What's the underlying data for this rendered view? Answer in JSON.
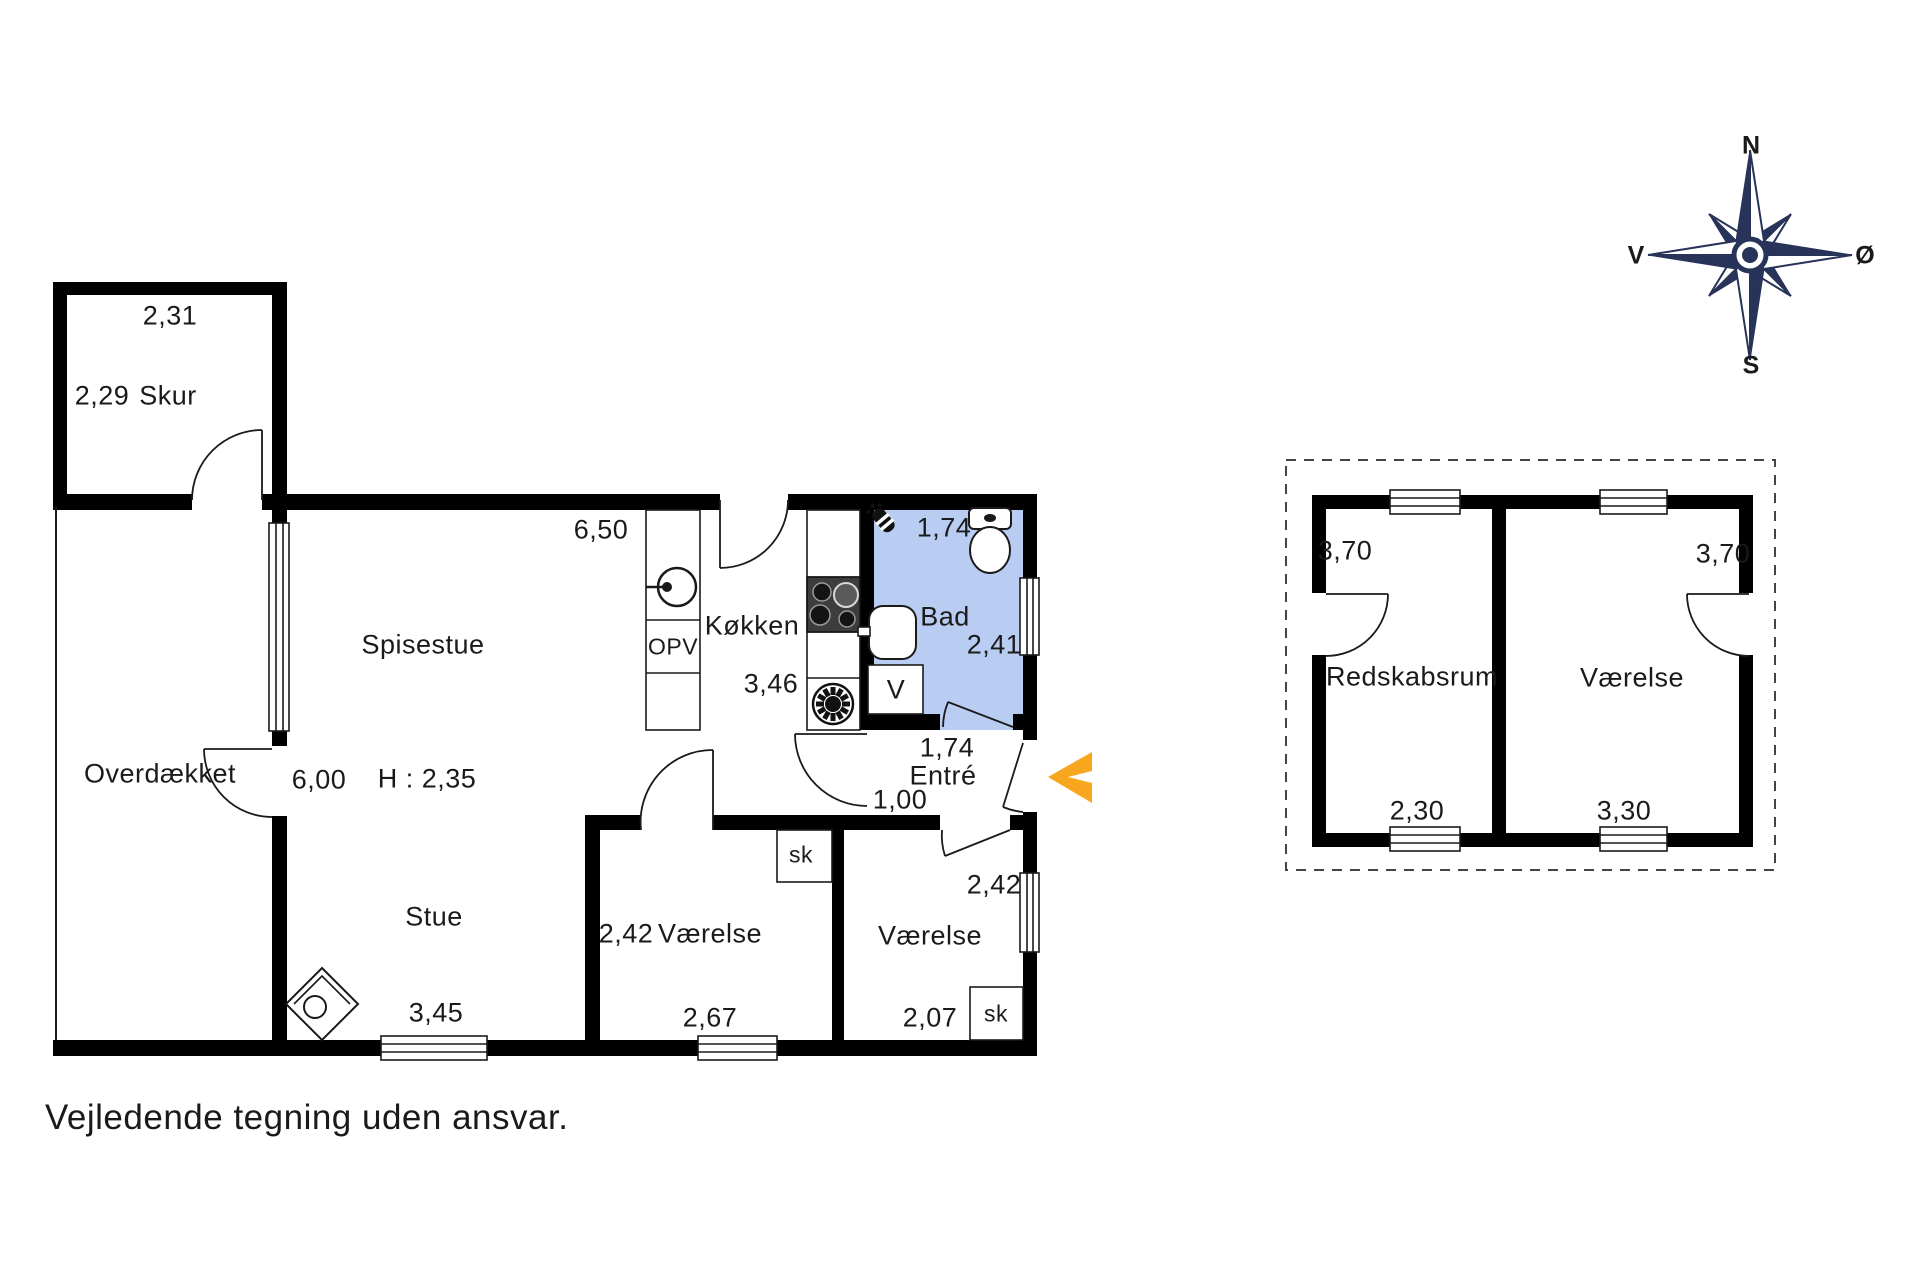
{
  "note": "Vejledende tegning uden ansvar.",
  "colors": {
    "wall": "#000000",
    "line": "#1a1a1a",
    "bath_fill": "#b9cdf2",
    "arrow_orange": "#f7a61e",
    "compass_navy": "#273358"
  },
  "compass": {
    "n": "N",
    "s": "S",
    "w": "V",
    "e": "Ø"
  },
  "main_house": {
    "skur": {
      "label": "Skur",
      "dim_width": "2,31",
      "dim_depth": "2,29"
    },
    "overdaekket": {
      "label": "Overdækket"
    },
    "spisestue": {
      "label": "Spisestue",
      "dim_width": "6,50",
      "dim_depth": "6,00",
      "ceiling_height": "H : 2,35"
    },
    "stue": {
      "label": "Stue",
      "dim_width": "3,45"
    },
    "koekken": {
      "label": "Køkken",
      "dim_depth": "3,46",
      "dishwasher": "OPV"
    },
    "bad": {
      "label": "Bad",
      "dim_width": "1,74",
      "dim_depth": "2,41",
      "washer": "V"
    },
    "entre": {
      "label": "Entré",
      "dim_width": "1,74",
      "hall_width": "1,00"
    },
    "vaerelse_1": {
      "label": "Værelse",
      "dim_depth": "2,42",
      "dim_width": "2,67",
      "closet": "sk"
    },
    "vaerelse_2": {
      "label": "Værelse",
      "dim_depth": "2,42",
      "dim_width": "2,07",
      "closet": "sk"
    }
  },
  "annex": {
    "redskabsrum": {
      "label": "Redskabsrum",
      "dim_depth": "3,70",
      "dim_width": "2,30"
    },
    "vaerelse": {
      "label": "Værelse",
      "dim_depth": "3,70",
      "dim_width": "3,30"
    }
  }
}
